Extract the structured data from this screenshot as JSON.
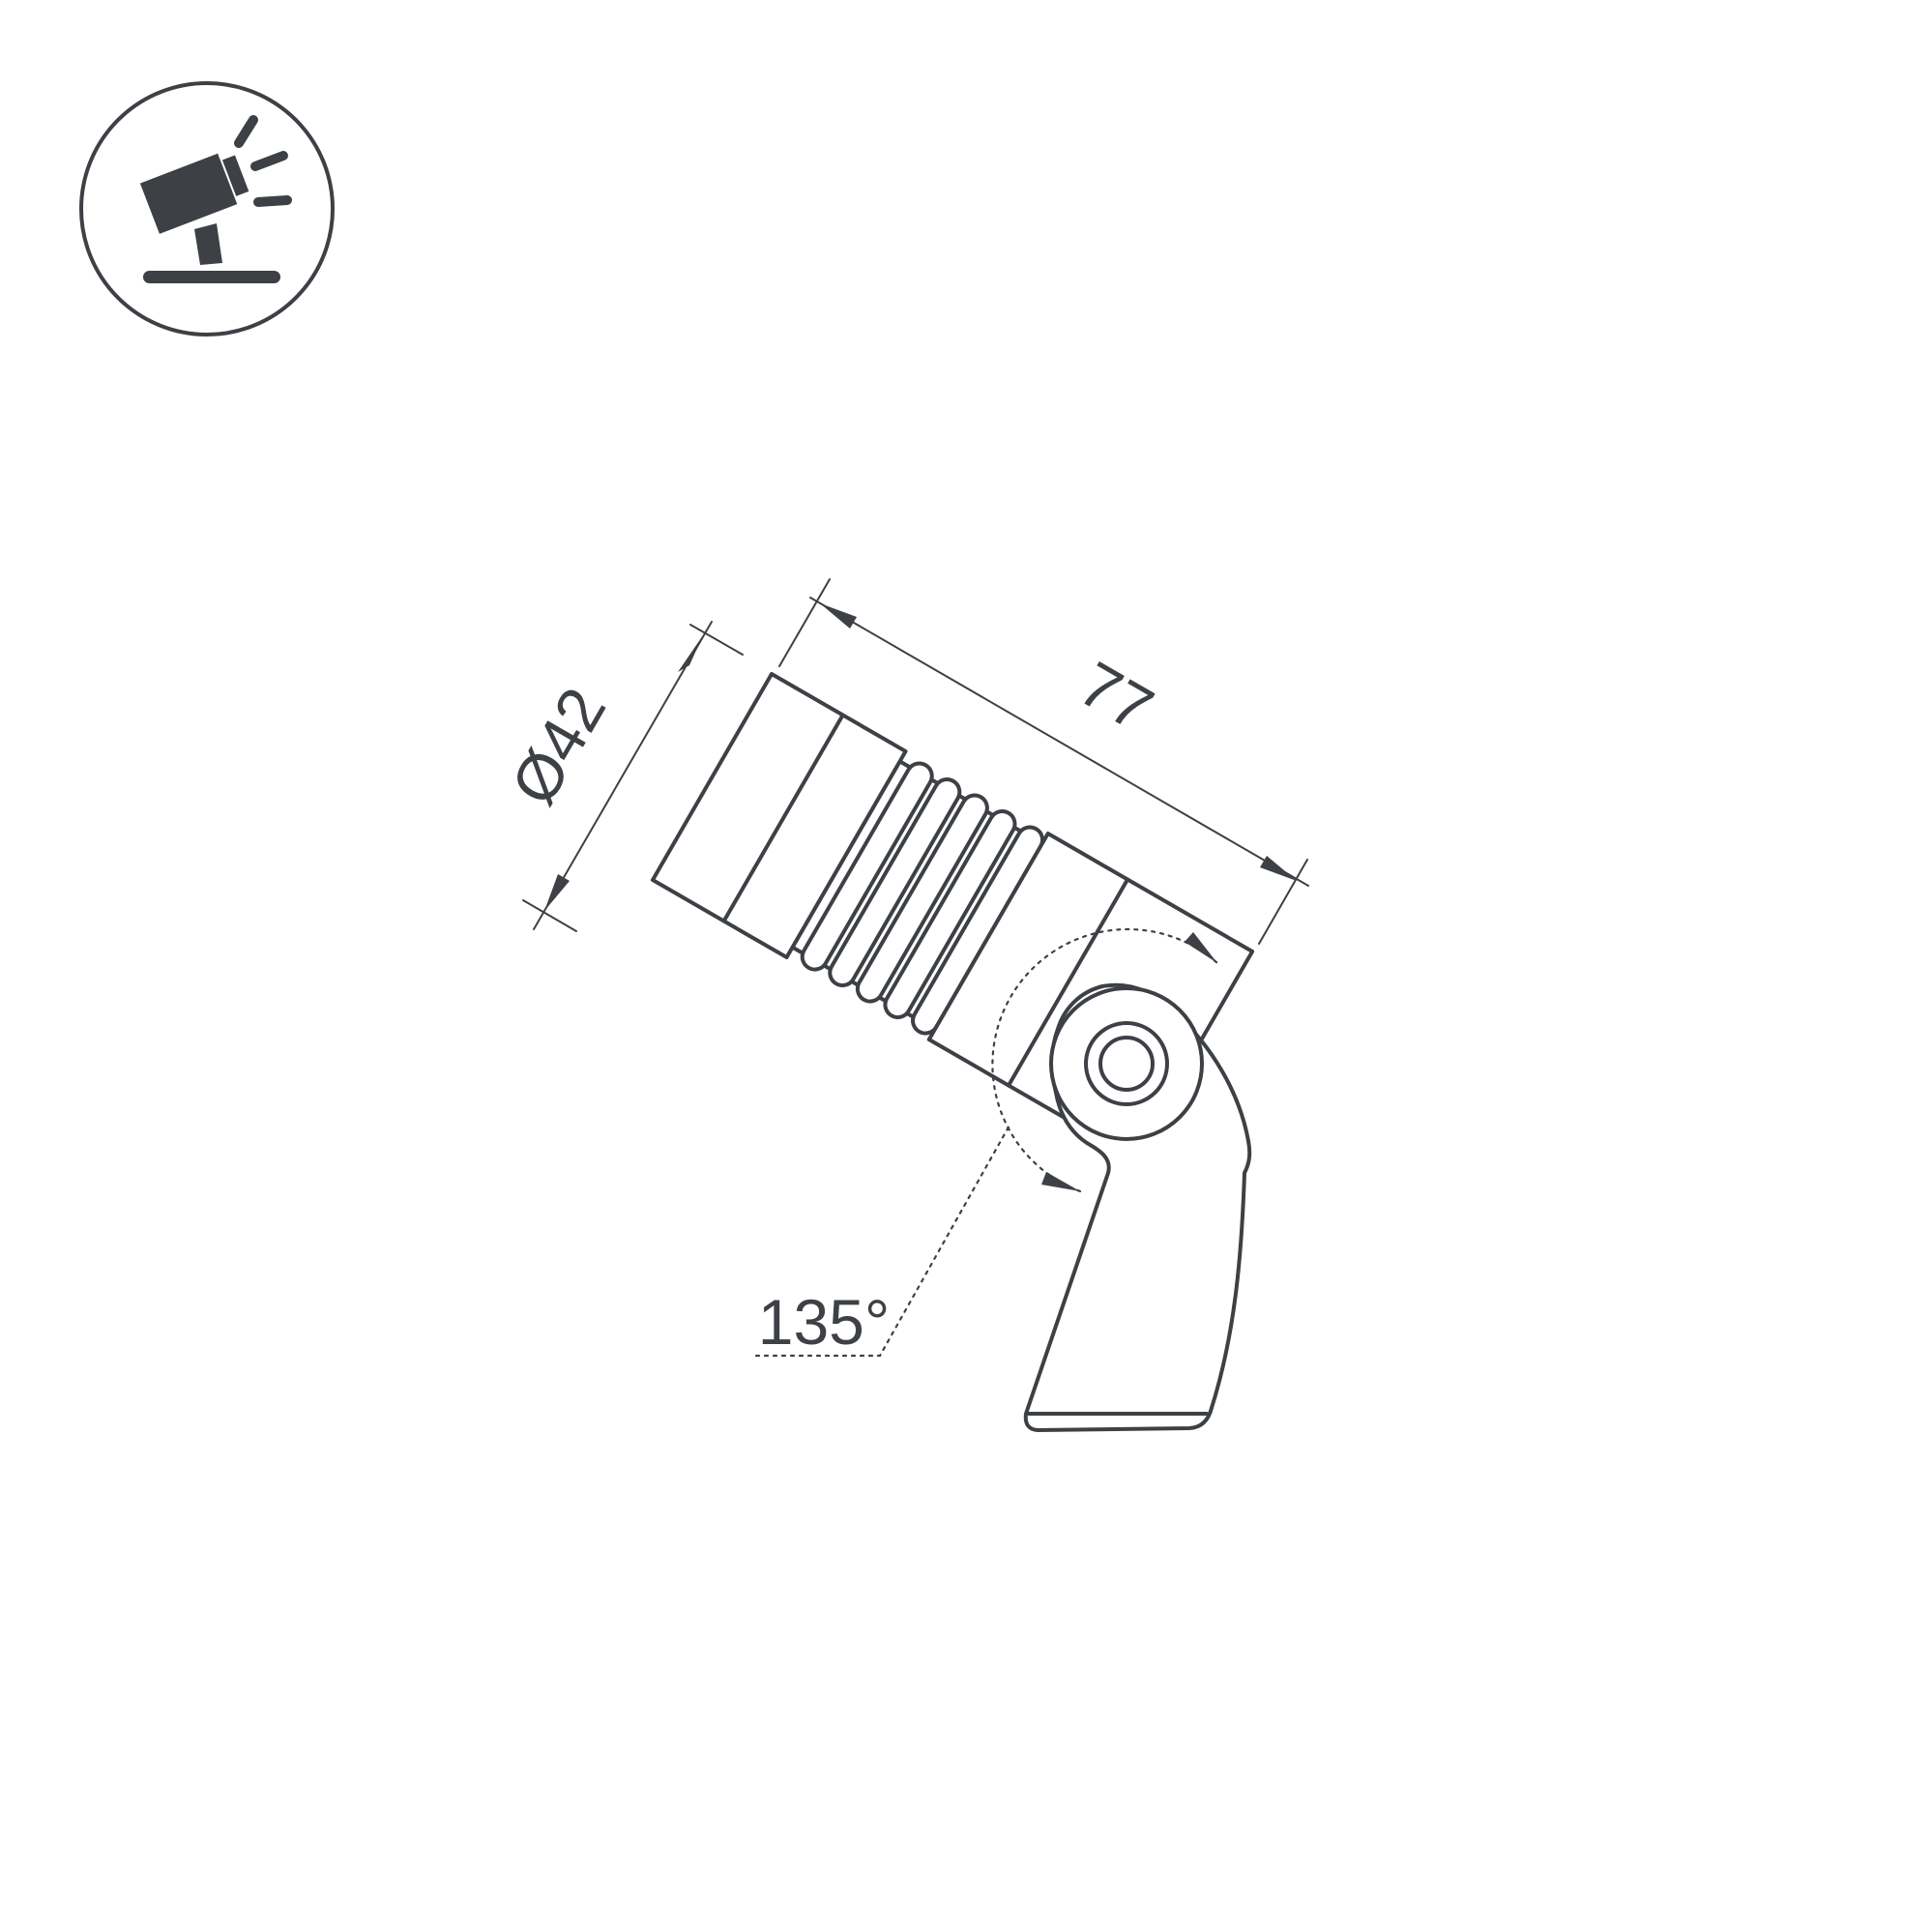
{
  "page": {
    "background_color": "#ffffff",
    "line_color": "#3d4045",
    "description": "Technical dimension drawing of an adjustable LED spotlight on a mounting bracket"
  },
  "icon": {
    "name": "adjustable-spotlight-icon",
    "color": "#3d4045"
  },
  "drawing": {
    "dimensions": {
      "diameter_label": "Ø42",
      "length_label": "77",
      "angle_label": "135°"
    }
  }
}
